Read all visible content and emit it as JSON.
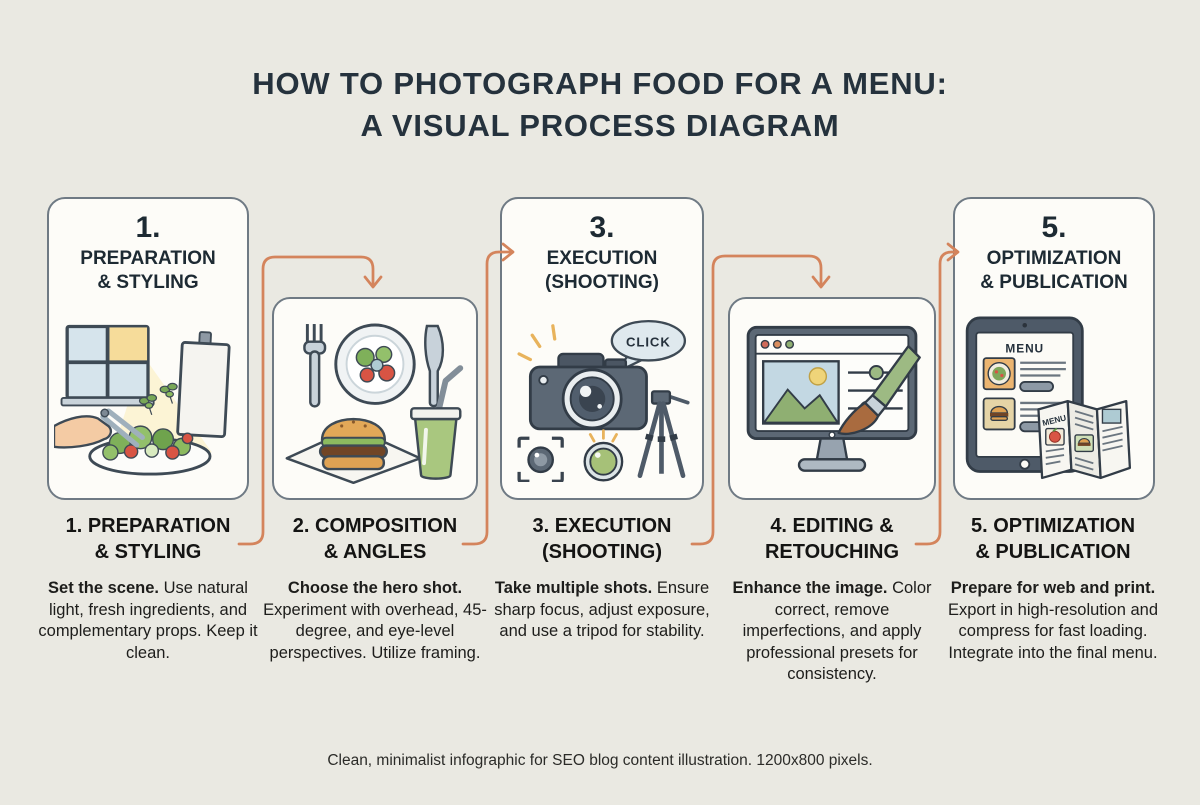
{
  "header": {
    "line1": "HOW TO PHOTOGRAPH FOOD FOR A MENU:",
    "line2": "A VISUAL PROCESS DIAGRAM"
  },
  "steps": [
    {
      "number": "1.",
      "card_heading_line1": "PREPARATION",
      "card_heading_line2": "& STYLING",
      "title_line1": "1. PREPARATION",
      "title_line2": "& STYLING",
      "lead": "Set the scene.",
      "body": "Use natural light, fresh ingredients, and complementary props. Keep it clean.",
      "icon": "food-styling-scene-icon"
    },
    {
      "number": "2.",
      "card_heading_line1": "",
      "card_heading_line2": "",
      "title_line1": "2. COMPOSITION",
      "title_line2": "& ANGLES",
      "lead": "Choose the hero shot.",
      "body": "Experiment with overhead, 45-degree, and eye-level perspectives. Utilize framing.",
      "icon": "food-composition-icon"
    },
    {
      "number": "3.",
      "card_heading_line1": "EXECUTION",
      "card_heading_line2": "(SHOOTING)",
      "title_line1": "3. EXECUTION",
      "title_line2": "(SHOOTING)",
      "lead": "Take multiple shots.",
      "body": "Ensure sharp focus, adjust exposure, and use a tripod for stability.",
      "icon": "camera-shooting-icon"
    },
    {
      "number": "4.",
      "card_heading_line1": "",
      "card_heading_line2": "",
      "title_line1": "4. EDITING &",
      "title_line2": "RETOUCHING",
      "lead": "Enhance the image.",
      "body": "Color correct, remove imperfections, and apply professional presets for consistency.",
      "icon": "photo-editing-icon"
    },
    {
      "number": "5.",
      "card_heading_line1": "OPTIMIZATION",
      "card_heading_line2": "& PUBLICATION",
      "title_line1": "5. OPTIMIZATION",
      "title_line2": "& PUBLICATION",
      "lead": "Prepare for web and print.",
      "body": "Export in high-resolution and compress for fast loading. Integrate into the final menu.",
      "icon": "menu-publication-icon"
    }
  ],
  "icons": {
    "click_label": "CLICK",
    "tablet_menu_label": "MENU",
    "brochure_menu_label": "MENU"
  },
  "footer": {
    "caption": "Clean, minimalist infographic for SEO blog content illustration. 1200x800 pixels."
  },
  "colors": {
    "background": "#EAE9E2",
    "card_fill": "#FDFCF8",
    "card_border": "#6F7A84",
    "arrow": "#D4845C",
    "heading": "#25323D",
    "text": "#1D1D1B"
  }
}
